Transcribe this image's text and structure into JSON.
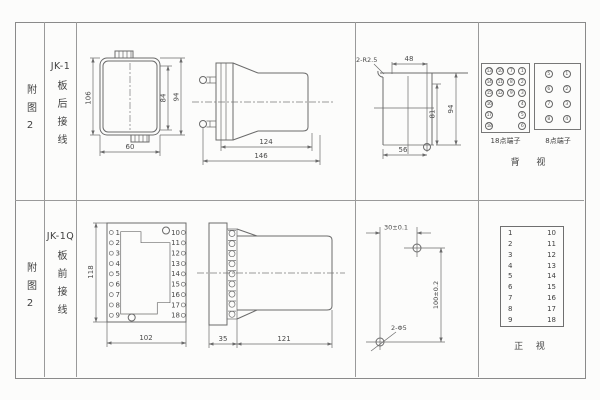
{
  "row1": {
    "appendix": "附图2",
    "model": "JK-1",
    "wiring": "板后接线",
    "front_view": {
      "dim_h": "106",
      "dim_inner": "84",
      "dim_outer": "94",
      "dim_w": "60"
    },
    "side_view": {
      "dim_body": "124",
      "dim_total": "146"
    },
    "cutout": {
      "note": "2-R2.5",
      "dim_top": "48",
      "dim_inner": "81",
      "dim_outer": "94",
      "dim_bottom": "56"
    },
    "terminals18": {
      "label": "18点端子",
      "rows": [
        [
          "13",
          "10",
          "7",
          "1"
        ],
        [
          "14",
          "11",
          "8",
          "2"
        ],
        [
          "15",
          "12",
          "9",
          "3"
        ],
        [
          "16",
          "",
          "",
          "4"
        ],
        [
          "17",
          "",
          "",
          "5"
        ],
        [
          "18",
          "",
          "",
          "6"
        ]
      ]
    },
    "terminals8": {
      "label": "8点端子",
      "rows": [
        [
          "5",
          "1"
        ],
        [
          "6",
          "2"
        ],
        [
          "7",
          "3"
        ],
        [
          "8",
          "4"
        ]
      ]
    },
    "view_label": "背 视"
  },
  "row2": {
    "appendix": "附图2",
    "model": "JK-1Q",
    "wiring": "板前接线",
    "plate": {
      "dim_h": "118",
      "dim_w": "102",
      "left_terminals": [
        "1",
        "2",
        "3",
        "4",
        "5",
        "6",
        "7",
        "8",
        "9"
      ],
      "right_terminals": [
        "10",
        "11",
        "12",
        "13",
        "14",
        "15",
        "16",
        "17",
        "18"
      ]
    },
    "side_view": {
      "dim_flange": "35",
      "dim_body": "121"
    },
    "drill": {
      "dim_h": "30±0.1",
      "dim_v": "100±0.2",
      "hole_note": "2-Φ5"
    },
    "conn_table": {
      "pairs": [
        [
          "1",
          "10"
        ],
        [
          "2",
          "11"
        ],
        [
          "3",
          "12"
        ],
        [
          "4",
          "13"
        ],
        [
          "5",
          "14"
        ],
        [
          "6",
          "15"
        ],
        [
          "7",
          "16"
        ],
        [
          "8",
          "17"
        ],
        [
          "9",
          "18"
        ]
      ]
    },
    "view_label": "正 视"
  }
}
